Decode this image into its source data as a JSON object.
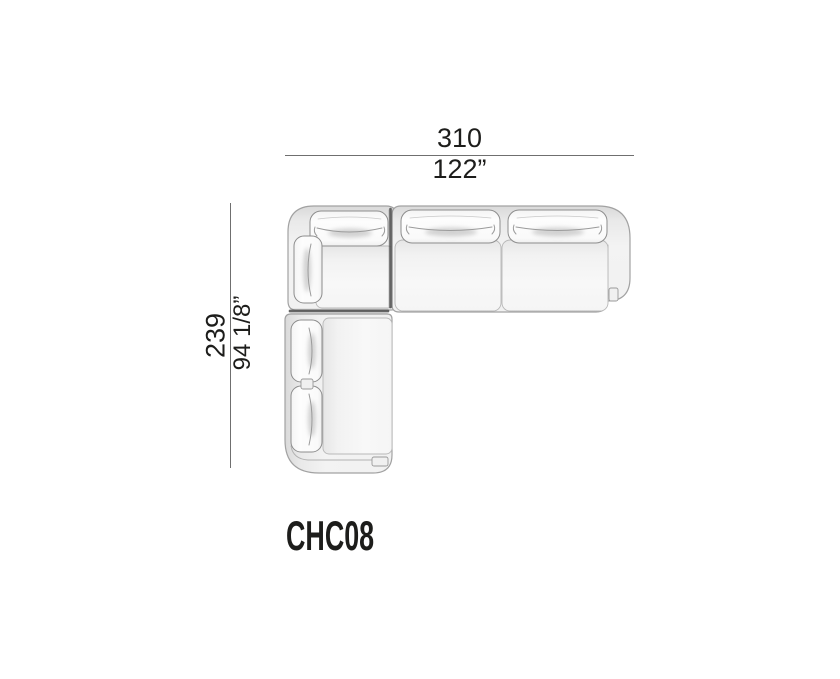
{
  "figure": {
    "product_code": "CHC08",
    "width": {
      "metric": "310",
      "imperial": "122”"
    },
    "depth": {
      "metric": "239",
      "imperial": "94 1/8”"
    }
  },
  "drawing": {
    "type": "sofa-sectional-top-view",
    "sections": [
      "corner-section",
      "middle-seat-section",
      "right-seat-section",
      "chaise-section"
    ]
  },
  "colors": {
    "background": "#ffffff",
    "text": "#1d1d1b",
    "dimension_line": "#6f6f6f",
    "outline": "#a2a2a2",
    "sofa_fill": "#f2f2f2",
    "cushion_fill": "#fcfcfc",
    "gap_shadow": "#4f4f4f"
  }
}
